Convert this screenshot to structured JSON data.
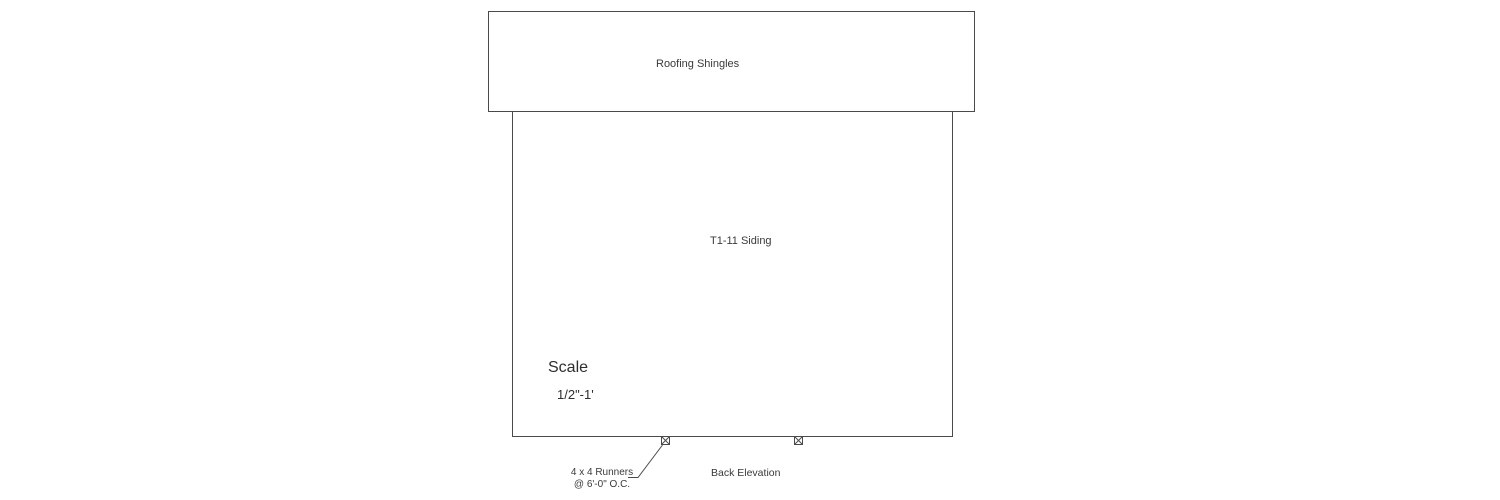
{
  "drawing": {
    "roof_label": "Roofing Shingles",
    "siding_label": "T1-11 Siding",
    "scale": {
      "heading": "Scale",
      "value": "1/2\"-1'"
    },
    "runners_note": {
      "line1": "4 x 4 Runners",
      "line2": "@ 6'-0\" O.C."
    },
    "caption": "Back Elevation",
    "colors": {
      "line": "#4a4a4a",
      "text": "#3a3a3a",
      "background": "#ffffff"
    }
  }
}
